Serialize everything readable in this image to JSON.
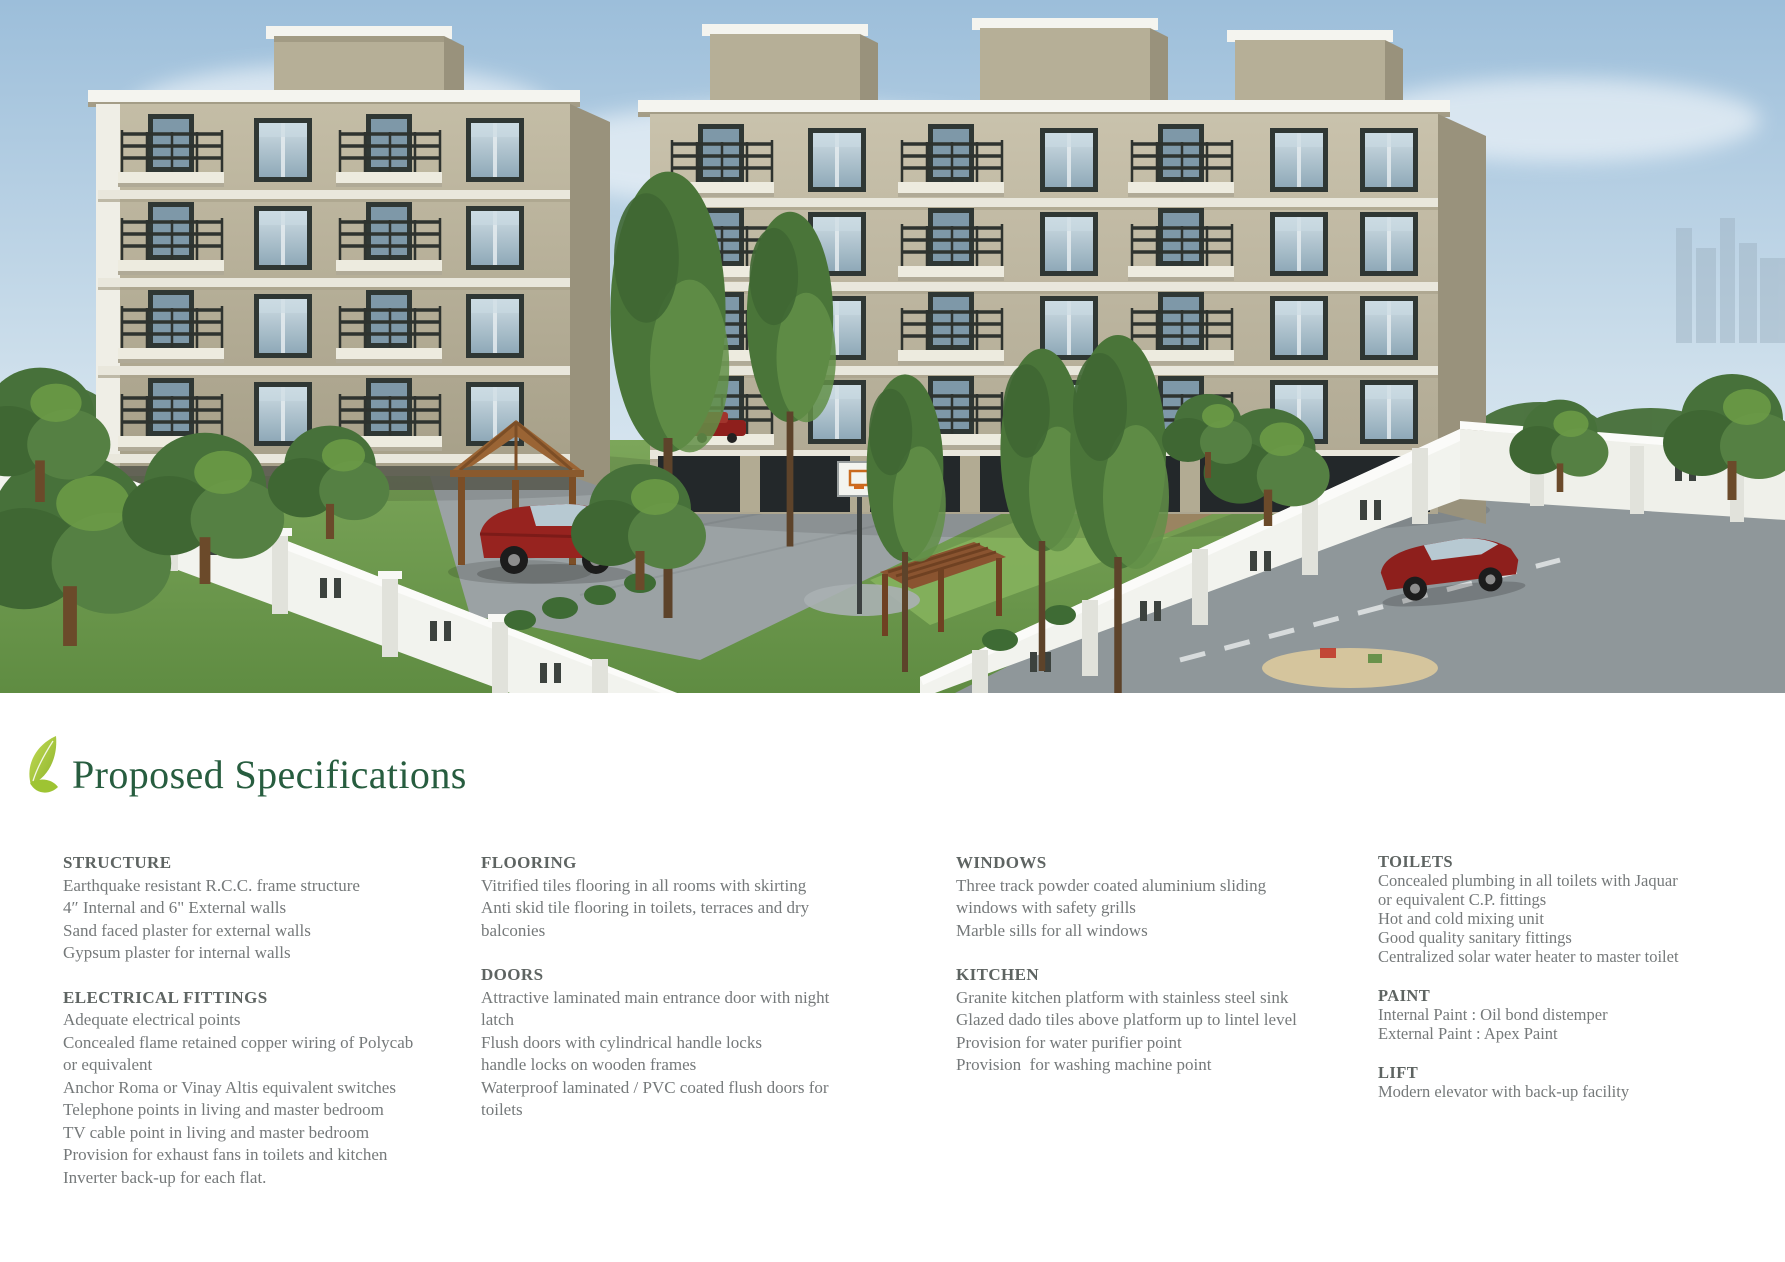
{
  "heading": {
    "text": "Proposed Specifications"
  },
  "theme": {
    "heading-green": "#275d3f",
    "section-title-gray": "#5e6462",
    "body-gray": "#75797a",
    "sky-top": "#9cbeda",
    "sky-bottom": "#e9f1f6",
    "wall-beige": "#b6af97",
    "wall-beige-light": "#c4bda6",
    "wall-shadow": "#99927c",
    "parapet-white": "#f4f4ef",
    "glass-dark": "#2f3734",
    "glass-blue": "#8fa9b8",
    "railing-dark": "#2e332f",
    "grass-green": "#6d9a4d",
    "lawn-light": "#84b05c",
    "tree-dark": "#47713a",
    "tree-light": "#6d9c46",
    "fence-white": "#f2f3ee",
    "pavement-gray": "#9ba2a4",
    "road-gray": "#8f979a",
    "car-red": "#97231f",
    "wood-brown": "#8a5a2e",
    "leaf-light": "#c3dc55",
    "leaf-dark": "#8db32b"
  },
  "specs": {
    "columns": [
      {
        "sections": [
          {
            "title": "STRUCTURE",
            "lines": [
              "Earthquake resistant R.C.C. frame structure",
              "4″ Internal and 6\" External walls",
              "Sand faced plaster for external walls",
              "Gypsum plaster for internal walls"
            ]
          },
          {
            "title": "ELECTRICAL FITTINGS",
            "lines": [
              "Adequate electrical points",
              "Concealed flame retained copper wiring of Polycab",
              "or equivalent",
              "Anchor Roma or Vinay Altis equivalent switches",
              "Telephone points in living and master bedroom",
              "TV cable point in living and master bedroom",
              "Provision for exhaust fans in toilets and kitchen",
              "Inverter back-up for each flat."
            ]
          }
        ]
      },
      {
        "sections": [
          {
            "title": "FLOORING",
            "lines": [
              "Vitrified tiles flooring in all rooms with skirting",
              "Anti skid tile flooring in toilets, terraces and dry",
              "balconies"
            ]
          },
          {
            "title": "DOORS",
            "lines": [
              "Attractive laminated main entrance door with night",
              "latch",
              "Flush doors with cylindrical handle locks",
              "handle locks on wooden frames",
              "Waterproof laminated / PVC coated flush doors for",
              "toilets"
            ]
          }
        ]
      },
      {
        "sections": [
          {
            "title": "WINDOWS",
            "lines": [
              "Three track powder coated aluminium sliding",
              "windows with safety grills",
              "Marble sills for all windows"
            ]
          },
          {
            "title": "KITCHEN",
            "lines": [
              "Granite kitchen platform with stainless steel sink",
              "Glazed dado tiles above platform up to lintel level",
              "Provision for water purifier point",
              "Provision  for washing machine point"
            ]
          }
        ]
      },
      {
        "sections": [
          {
            "title": "TOILETS",
            "lines": [
              "Concealed plumbing in all toilets with Jaquar",
              "or equivalent C.P. fittings",
              "Hot and cold mixing unit",
              "Good quality sanitary fittings",
              "Centralized solar water heater to master toilet"
            ]
          },
          {
            "title": "PAINT",
            "lines": [
              "Internal Paint : Oil bond distemper",
              "External Paint : Apex Paint"
            ]
          },
          {
            "title": "LIFT",
            "lines": [
              "Modern elevator with back-up facility"
            ]
          }
        ]
      }
    ]
  }
}
